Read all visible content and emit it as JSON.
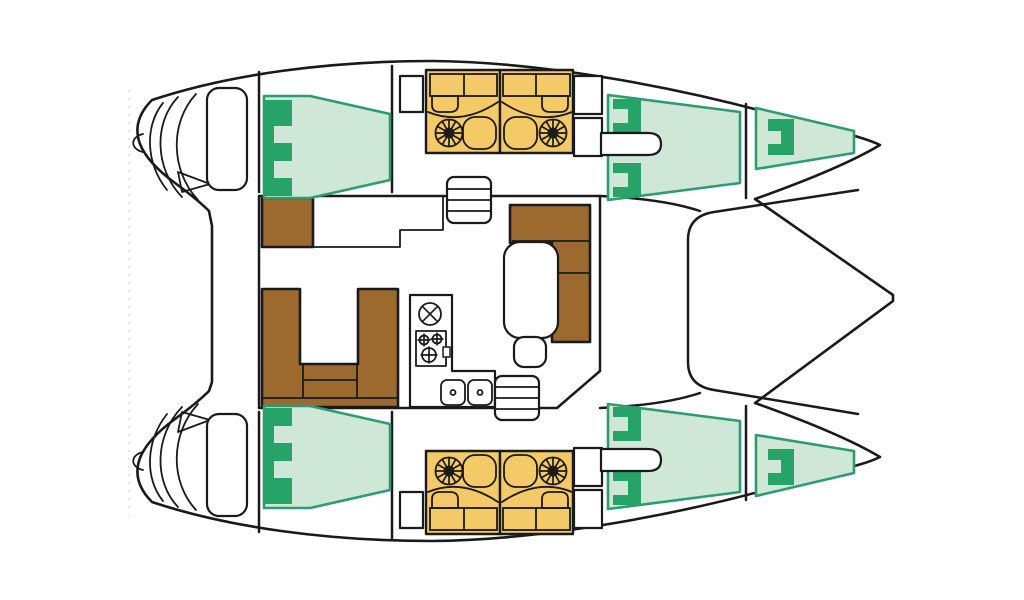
{
  "page": {
    "background": "#ffffff",
    "description": "Top-down interior floor plan diagram of a sailing catamaran, bows to the right, transoms and cockpit to the left"
  },
  "colors": {
    "outline": "#1a1a1a",
    "deck": "#ffffff",
    "berth": "#cfe7d7",
    "berth-border": "#2f9b70",
    "berth-accent": "#26a366",
    "head": "#f4c968",
    "sofa": "#9c6a2f",
    "ghost": "#dde9e1"
  },
  "icons": [
    {
      "name": "fan-vent-icon",
      "glyph": "spoked-circle",
      "count": 4
    },
    {
      "name": "toilet-icon",
      "glyph": "rounded-bowl",
      "count": 4
    },
    {
      "name": "sink-basin-icon",
      "glyph": "rounded-bowl",
      "count": 4
    },
    {
      "name": "double-sink-icon",
      "glyph": "two-rounded-squares-with-drains",
      "count": 1
    },
    {
      "name": "stove-burners-icon",
      "glyph": "three-crossed-circles",
      "count": 1
    },
    {
      "name": "round-hatch-icon",
      "glyph": "circle-with-x",
      "count": 1
    },
    {
      "name": "stairs-icon",
      "glyph": "ladder-rungs",
      "count": 2
    },
    {
      "name": "davit-hook-icon",
      "glyph": "small-c-curve",
      "count": 2
    }
  ],
  "compartments": {
    "hull_each": [
      "transom-steps",
      "helm-bench",
      "aft-cabin-berth-with-e-headboard",
      "head-outboard-with-fan-toilet-sink",
      "head-inboard-with-fan-toilet-sink",
      "wardrobe-cabinets",
      "forward-cabin-double-berth-with-pillows",
      "forepeak-berth-with-pillow"
    ],
    "bridgedeck": [
      "cockpit",
      "nav-seat",
      "mast-step-platform",
      "companionway-stairs-starboard",
      "companionway-stairs-port",
      "u-shaped-sofa",
      "saloon-l-sofa",
      "saloon-table",
      "stool",
      "galley-l-counter",
      "foredeck"
    ]
  }
}
